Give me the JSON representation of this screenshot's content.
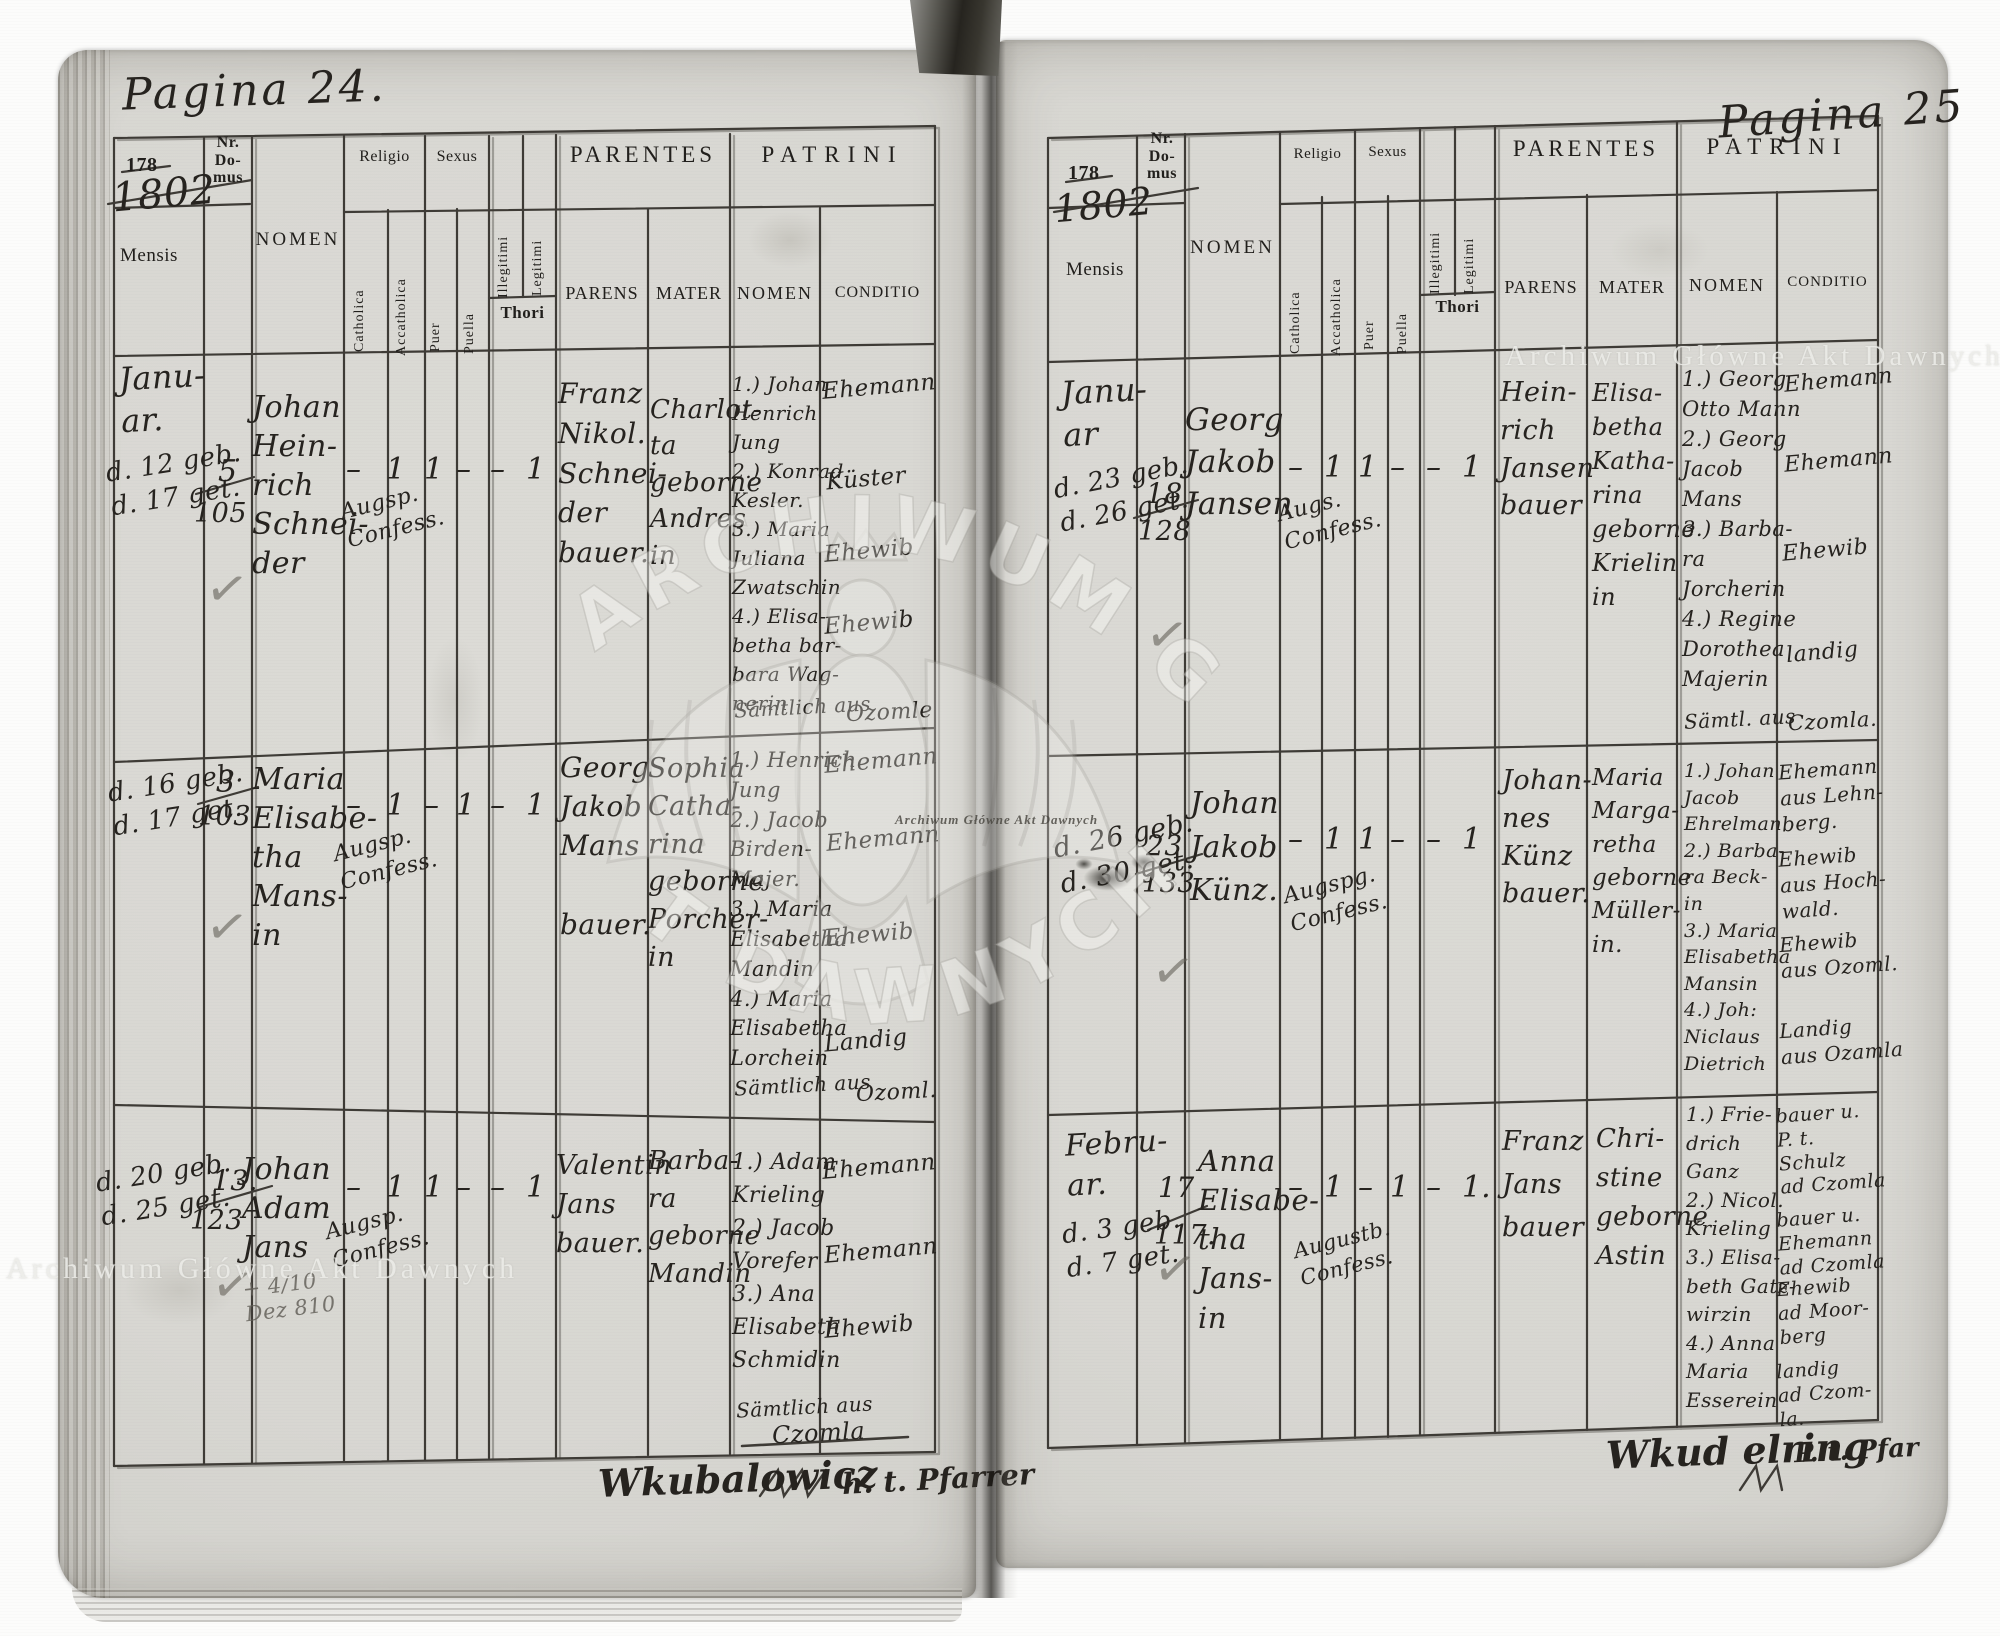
{
  "columns": {
    "nr": "Nr.\nDo-\nmus",
    "mensis": "Mensis",
    "nomen": "NOMEN",
    "religio": "Religio",
    "catholica": "Catholica",
    "acatholica": "Accatholica",
    "sexus": "Sexus",
    "puer": "Puer",
    "puella": "Puella",
    "illegitimi": "Illegitimi",
    "legitimi": "Legitimi",
    "thori": "Thori",
    "parentes": "PARENTES",
    "parens": "PARENS",
    "mater": "MATER",
    "patrini": "PATRINI",
    "patrini_nomen": "NOMEN",
    "conditio": "CONDITIO"
  },
  "glyphs": {
    "check": "✓"
  },
  "watermark": {
    "light_text": "Archiwum Główne Akt Dawnych",
    "small_text": "Archiwum Główne Akt Dawnych",
    "arc_top": "ARCHIWUM GŁÓW",
    "arc_bottom": "T DAWNYCH"
  },
  "left": {
    "pagina": "Pagina 24.",
    "year_printed": "178",
    "year_hand": "1802",
    "signature_name": "Wkubalowicz",
    "signature_title": "h. t. Pfarrer",
    "entries": [
      {
        "month": "Janu-\nar.",
        "dates": "d. 12 geb.\nd. 17 get.",
        "nr_top": "5",
        "nr_bottom": "105",
        "name": "Johan\nHein-\nrich\nSchnei-\nder",
        "confession": "Augsp.\nConfess.",
        "marks": [
          "–",
          "1",
          "1",
          "–",
          "–",
          "1"
        ],
        "parens": "Franz\nNikol.\nSchnei-\nder\nbauer.",
        "mater": "Charlot-\nta\ngeborne\nAndres\nin",
        "patrini": "1.) Johan\nHenrich\nJung\n2.) Konrad\nKesler.\n3.) Maria\nJuliana\nZwatschin\n4.) Elisa-\nbetha bar-\nbara Wag-\nnerin",
        "patrini_footer": "Sämtlich aus",
        "patrini_place": "Ozomle",
        "conditio": [
          "Ehemann",
          "Küster",
          "Ehewib",
          "Ehewib"
        ]
      },
      {
        "month": "",
        "dates": "d. 16 geb.\nd. 17 get.",
        "nr_top": "3",
        "nr_bottom": "103",
        "name": "Maria\nElisabe-\ntha\nMans-\nin",
        "confession": "Augsp.\nConfess.",
        "marks": [
          "–",
          "1",
          "–",
          "1",
          "–",
          "1"
        ],
        "parens": "Georg\nJakob\nMans\n\nbauer.",
        "mater": "Sophia\nCatha-\nrina\ngeborne\nPorcher-\nin",
        "patrini": "1.) Henrich\nJung\n2.) Jacob\nBirden-\nMajer.\n3.) Maria\nElisabetha\nMandin\n4.) Maria\nElisabetha\nLorchein",
        "patrini_footer": "Sämtlich aus",
        "patrini_place": "Ozoml.",
        "conditio": [
          "Ehemann",
          "Ehemann",
          "Ehewib",
          "Landig"
        ]
      },
      {
        "month": "",
        "dates": "d. 20 geb.\nd. 25 get.",
        "nr_top": "13.",
        "nr_bottom": "123",
        "name": "Johan\nAdam\nJans",
        "confession": "Augsp.\nConfess.",
        "pencil_note": "+ 4/10\nDez 810",
        "marks": [
          "–",
          "1",
          "1",
          "–",
          "–",
          "1"
        ],
        "parens": "Valentin\nJans\nbauer.",
        "mater": "Barba-\nra\ngeborne\nMandin",
        "patrini": "1.) Adam\nKrieling\n2.) Jacob\nVorefer\n3.) Ana\nElisabeth\nSchmidin",
        "patrini_footer": "Sämtlich aus",
        "patrini_place": "Czomla",
        "conditio": [
          "Ehemann",
          "Ehemann",
          "Ehewib"
        ]
      }
    ]
  },
  "right": {
    "pagina": "Pagina 25",
    "year_printed": "178",
    "year_hand": "1802",
    "signature_name": "Wkud elring",
    "signature_title": "P. t. Pfar",
    "entries": [
      {
        "month": "Janu-\nar",
        "dates": "d. 23 geb.\nd. 26 get.",
        "nr_top": "18",
        "nr_bottom": "128",
        "name": "Georg\nJakob\nJansen",
        "confession": "Augs.\nConfess.",
        "marks": [
          "–",
          "1",
          "1",
          "–",
          "–",
          "1"
        ],
        "parens": "Hein-\nrich\nJansen\nbauer",
        "mater": "Elisa-\nbetha\nKatha-\nrina\ngeborne\nKrielin\nin",
        "patrini": "1.) Georg\nOtto Mann\n2.) Georg\nJacob\nMans\n3.) Barba-\nra\nJorcherin\n4.) Regine\nDorothea\nMajerin",
        "patrini_footer": "Sämtl. aus",
        "patrini_place": "Czomla.",
        "conditio": [
          "Ehemann",
          "Ehemann",
          "Ehewib",
          "landig"
        ]
      },
      {
        "month": "",
        "dates": "d. 26 geb.\nd. 30 get.",
        "nr_top": "23",
        "nr_bottom": "133",
        "name": "Johan\nJakob\nKünz.",
        "confession": "Augspg.\nConfess.",
        "marks": [
          "–",
          "1",
          "1",
          "–",
          "–",
          "1"
        ],
        "parens": "Johan-\nnes\nKünz\nbauer.",
        "mater": "Maria\nMarga-\nretha\ngeborne\nMüller-\nin.",
        "patrini": "1.) Johan\nJacob\nEhrelman\n2.) Barba-\nra Beck-\nin\n3.) Maria\nElisabetha\nMansin\n4.) Joh:\nNiclaus\nDietrich",
        "conditio": [
          "Ehemann\naus Lehn-\nberg.",
          "Ehewib\naus Hoch-\nwald.",
          "Ehewib\naus Ozoml.",
          "Landig\naus Ozamla"
        ]
      },
      {
        "month": "Febru-\nar.",
        "dates": "d. 3 geb.\nd. 7 get.",
        "nr_top": "17",
        "nr_bottom": "117.",
        "name": "Anna\nElisabe-\ntha\nJans-\nin",
        "confession": "Augustb.\nConfess.",
        "marks": [
          "–",
          "1",
          "–",
          "1",
          "–",
          "1."
        ],
        "parens": "Franz\nJans\nbauer",
        "mater": "Chri-\nstine\ngeborne\nAstin",
        "patrini": "1.) Frie-\ndrich\nGanz\n2.) Nicol.\nKrieling\n3.) Elisa-\nbeth Gatz-\nwirzin\n4.) Anna\nMaria\nEsserein",
        "conditio": [
          "bauer u.\nP. t.\nSchulz\nad Czomla",
          "bauer u.\nEhemann\nad Czomla",
          "Ehewib\nad Moor-\nberg",
          "landig\nad Czom-\nla."
        ]
      }
    ]
  }
}
